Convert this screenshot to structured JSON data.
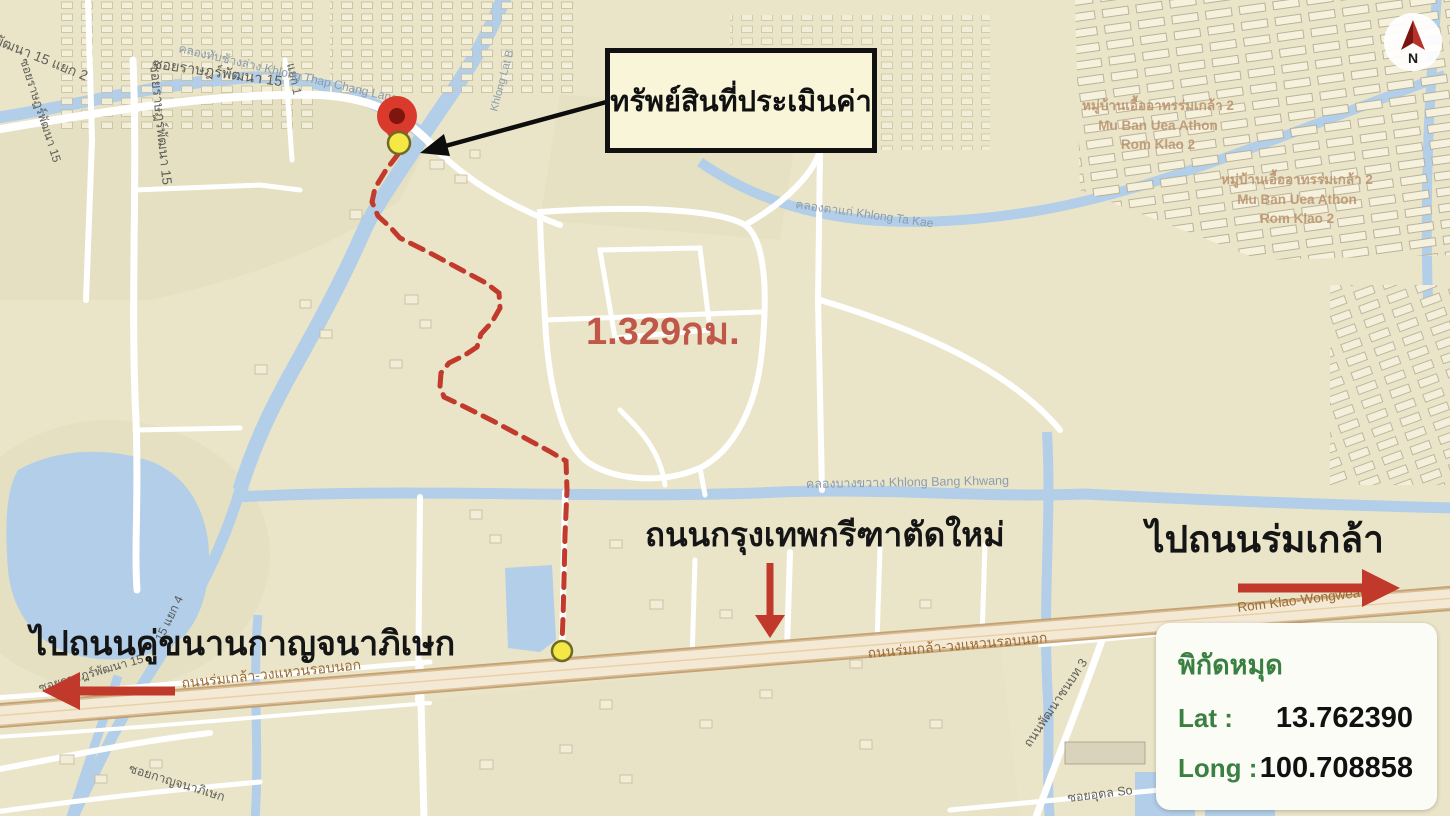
{
  "annotations": {
    "callout_label": "ทรัพย์สินที่ประเมินค่า",
    "distance_label": "1.329กม.",
    "new_road_label": "ถนนกรุงเทพกรีฑาตัดใหม่",
    "to_rom_klao_label": "ไปถนนร่มเกล้า",
    "to_kanchanaphisek_label": "ไปถนนคู่ขนานกาญจนาภิเษก"
  },
  "compass": {
    "north_label": "N"
  },
  "coordinate_box": {
    "title": "พิกัดหมุด",
    "lat_label": "Lat :",
    "lat_value": "13.762390",
    "long_label": "Long :",
    "long_value": "100.708858"
  },
  "map_labels": {
    "soi_rat_phatthana_15_yaek_2": "ซอยราษฎร์พัฒนา 15 แยก 2",
    "soi_rat_phatthana_15_top": "ซอยราษฎร์พัฒนา 15",
    "soi_rat_phatthana_15_vertical": "ซอยราษฎร์พัฒนา 15",
    "soi_rat_phatthana_15_left": "ซอยราษฎร์พัฒนา 15",
    "soi_rat_phatthana_15_lower": "ซอยราษฎร์พัฒนา 15",
    "yaek_1": "แยก 1",
    "yaek_4": "15 แยก 4",
    "khlong_thap_chang_lang": "คลองทับช้างล่าง Khlong Thap Chang Lang",
    "khlong_lat": "Khlong Lat B",
    "khlong_ta_kae": "คลองตาแก่ Khlong Ta Kae",
    "khlong_bang_khwang": "คลองบางขวาง Khlong Bang Khwang",
    "muban_line1": "หมู่บ้านเอื้ออาทรร่มเกล้า 2",
    "muban_line2": "Mu Ban Uea Athon",
    "muban_line3": "Rom Klao 2",
    "rom_klao_wongwaen_th": "ถนนร่มเกล้า-วงแหวนรอบนอก",
    "rom_klao_wongwaen_en": "Rom Klao-Wongwean Ro",
    "thanon_phatthana_chonnabot": "ถนนพัฒนาชนบท 3",
    "soi_udon": "ซอยอุดล So",
    "soi_kanchanaphisek": "ซอยกาญจนาภิเษก"
  },
  "colors": {
    "map_base": "#eae5c9",
    "water": "#b2cee8",
    "route_red": "#c13a2c",
    "arrow_red": "#c0392b",
    "callout_bg": "#f8f5d9",
    "callout_border": "#111111",
    "distance_text": "#c0584a",
    "coord_green": "#3a8040",
    "pin_red": "#d93a2b",
    "pin_core": "#7e150e",
    "marker_yellow": "#f5e844"
  }
}
